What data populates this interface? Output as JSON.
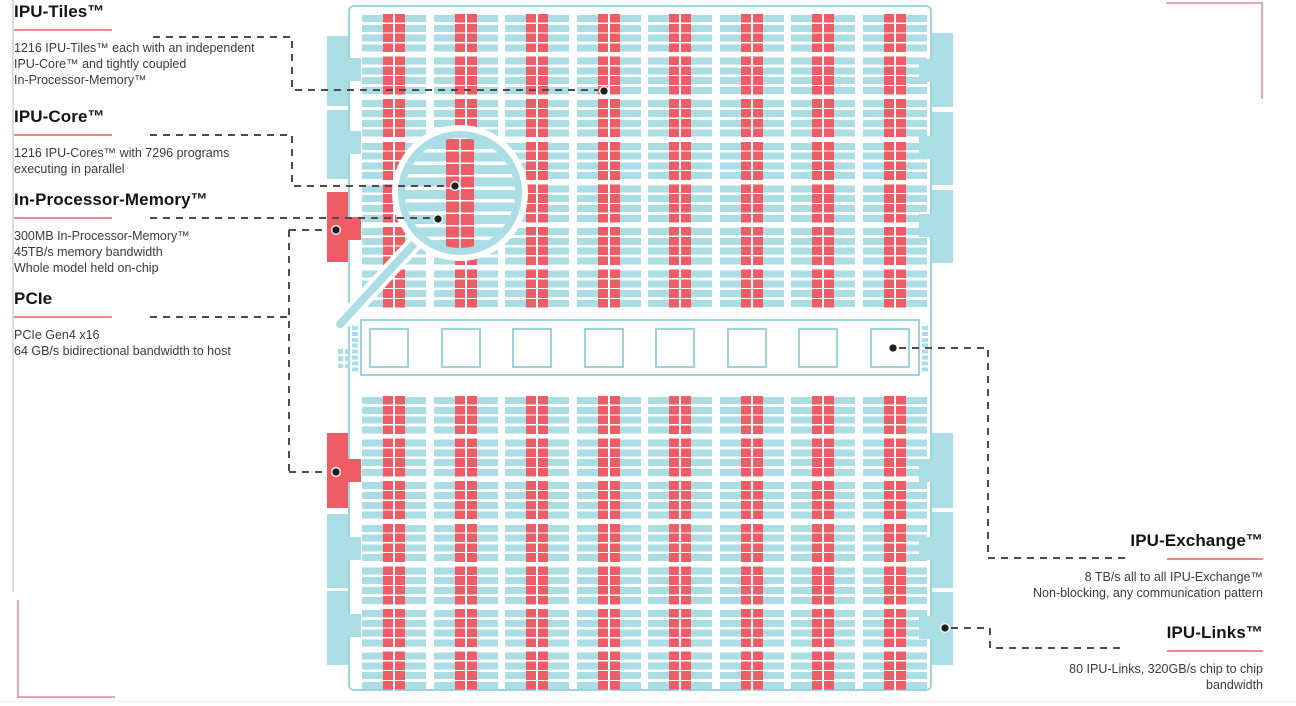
{
  "page": {
    "background": "#ffffff"
  },
  "colors": {
    "tile_blue": "#abdee4",
    "line_teal": "#9bd4dc",
    "core_red": "#ee5c66",
    "underline_pink": "#f2848c",
    "bracket_pink": "#e8a3ab",
    "dash_gray": "#4c4c4c",
    "dot_black": "#1e1e1e",
    "heading_text": "#141414",
    "body_text": "#3b3b3b",
    "frame_gray": "#dcdcdc"
  },
  "callouts_left": [
    {
      "id": "ipu-tiles",
      "title": "IPU-Tiles™",
      "lines": [
        "1216 IPU-Tiles™ each with an independent",
        "IPU-Core™ and tightly coupled",
        "In-Processor-Memory™"
      ]
    },
    {
      "id": "ipu-core",
      "title": "IPU-Core™",
      "lines": [
        "1216 IPU-Cores™ with 7296 programs",
        "executing in parallel"
      ]
    },
    {
      "id": "in-processor-memory",
      "title": "In-Processor-Memory™",
      "lines": [
        "300MB In-Processor-Memory™",
        "45TB/s memory bandwidth",
        "Whole model held on-chip"
      ]
    },
    {
      "id": "pcie",
      "title": "PCIe",
      "lines": [
        "PCIe Gen4 x16",
        "64 GB/s bidirectional bandwidth to host"
      ]
    }
  ],
  "callouts_right": [
    {
      "id": "ipu-exchange",
      "title": "IPU-Exchange™",
      "lines": [
        "8 TB/s all to all IPU-Exchange™",
        "Non-blocking, any communication pattern"
      ]
    },
    {
      "id": "ipu-links",
      "title": "IPU-Links™",
      "lines": [
        "80 IPU-Links, 320GB/s chip to chip",
        "bandwidth"
      ]
    }
  ],
  "diagram": {
    "tile_columns": 8,
    "tile_rows_per_half": 28,
    "tile_row_groups": 7,
    "exchange_squares": 8,
    "connectors": [
      {
        "side": "left",
        "color": "blue",
        "y": 36,
        "h": 70,
        "tabY": 58
      },
      {
        "side": "left",
        "color": "blue",
        "y": 110,
        "h": 69,
        "tabY": 131
      },
      {
        "side": "left",
        "color": "red",
        "y": 192,
        "h": 70,
        "tabY": 217
      },
      {
        "side": "left",
        "color": "red",
        "y": 433,
        "h": 75,
        "tabY": 459
      },
      {
        "side": "left",
        "color": "blue",
        "y": 514,
        "h": 74,
        "tabY": 537
      },
      {
        "side": "left",
        "color": "blue",
        "y": 591,
        "h": 74,
        "tabY": 614
      },
      {
        "side": "right",
        "color": "blue",
        "y": 33,
        "h": 74,
        "tabY": 59
      },
      {
        "side": "right",
        "color": "blue",
        "y": 112,
        "h": 73,
        "tabY": 136
      },
      {
        "side": "right",
        "color": "blue",
        "y": 190,
        "h": 73,
        "tabY": 214
      },
      {
        "side": "right",
        "color": "blue",
        "y": 433,
        "h": 75,
        "tabY": 459
      },
      {
        "side": "right",
        "color": "blue",
        "y": 512,
        "h": 76,
        "tabY": 537
      },
      {
        "side": "right",
        "color": "blue",
        "y": 592,
        "h": 73,
        "tabY": 616
      }
    ],
    "annotations": [
      {
        "name": "ipu-tiles-line",
        "polylines": [
          [
            [
              153,
              37
            ],
            [
              292,
              37
            ],
            [
              292,
              90
            ],
            [
              598,
              90
            ]
          ]
        ],
        "dots": [
          [
            604,
            91
          ]
        ]
      },
      {
        "name": "ipu-core-line",
        "polylines": [
          [
            [
              150,
              135
            ],
            [
              292,
              135
            ],
            [
              292,
              186
            ],
            [
              448,
              186
            ]
          ]
        ],
        "dots": [
          [
            455,
            186
          ]
        ]
      },
      {
        "name": "in-processor-memory-line",
        "polylines": [
          [
            [
              150,
              218
            ],
            [
              430,
              218
            ]
          ]
        ],
        "dots": [
          [
            438,
            219
          ]
        ]
      },
      {
        "name": "pcie-line",
        "polylines": [
          [
            [
              150,
              317
            ],
            [
              289,
              317
            ]
          ],
          [
            [
              289,
              230
            ],
            [
              289,
              472
            ]
          ],
          [
            [
              289,
              230
            ],
            [
              328,
              230
            ]
          ],
          [
            [
              289,
              472
            ],
            [
              328,
              472
            ]
          ]
        ],
        "dots": [
          [
            336,
            230
          ],
          [
            336,
            472
          ]
        ]
      },
      {
        "name": "ipu-exchange-line",
        "polylines": [
          [
            [
              899,
              348
            ],
            [
              988,
              348
            ],
            [
              988,
              558
            ],
            [
              1131,
              558
            ]
          ]
        ],
        "dots": [
          [
            893,
            348
          ]
        ]
      },
      {
        "name": "ipu-links-line",
        "polylines": [
          [
            [
              951,
              628
            ],
            [
              990,
              628
            ],
            [
              990,
              648
            ],
            [
              1121,
              648
            ]
          ]
        ],
        "dots": [
          [
            945,
            628
          ]
        ]
      }
    ]
  }
}
